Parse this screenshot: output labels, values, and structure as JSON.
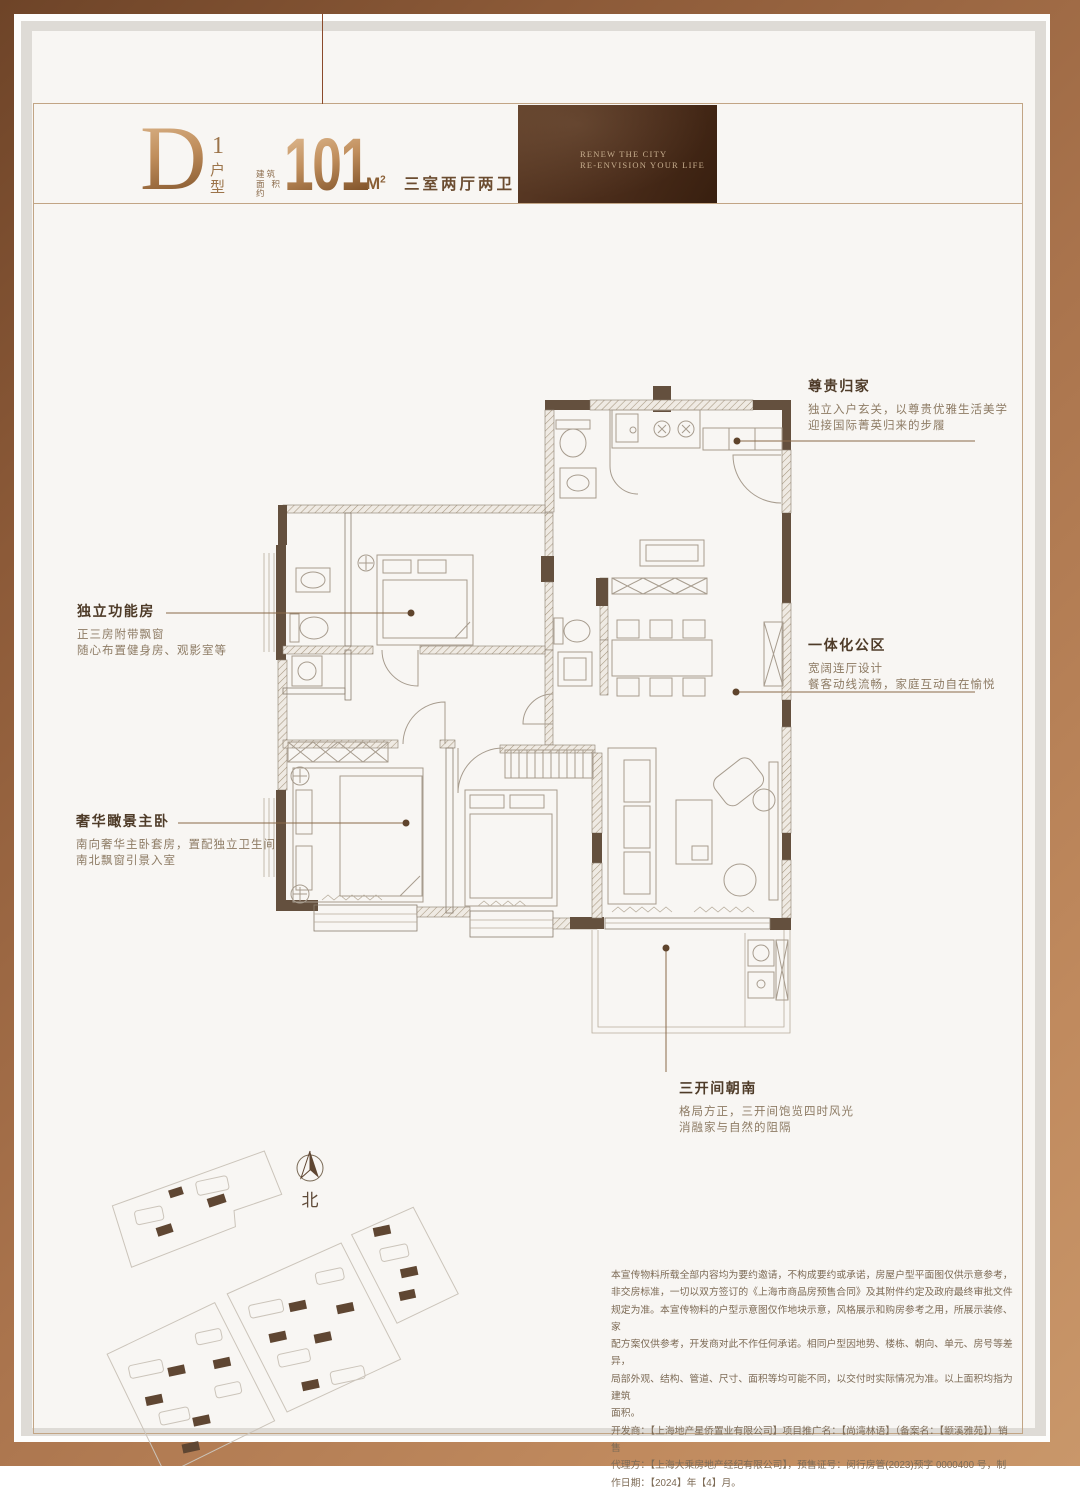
{
  "title_block": {
    "unit_letter": "D",
    "unit_number": "1",
    "unit_label": "户型",
    "area_prefix_1": "建筑",
    "area_prefix_2": "面积约",
    "area_value": "101",
    "area_unit_base": "M",
    "area_unit_exp": "2",
    "layout_summary": "三室两厅两卫",
    "brand_line1": "RENEW THE CITY",
    "brand_line2": "RE-ENVISION YOUR LIFE"
  },
  "callouts": {
    "homecoming": {
      "title": "尊贵归家",
      "body1": "独立入户玄关，以尊贵优雅生活美学",
      "body2": "迎接国际菁英归来的步履"
    },
    "function_room": {
      "title": "独立功能房",
      "body1": "正三房附带飘窗",
      "body2": "随心布置健身房、观影室等"
    },
    "public_area": {
      "title": "一体化公区",
      "body1": "宽阔连厅设计",
      "body2": "餐客动线流畅，家庭互动自在愉悦"
    },
    "master_bedroom": {
      "title": "奢华瞰景主卧",
      "body1": "南向奢华主卧套房，置配独立卫生间",
      "body2": "南北飘窗引景入室"
    },
    "south_bays": {
      "title": "三开间朝南",
      "body1": "格局方正，三开间饱览四时风光",
      "body2": "消融家与自然的阻隔"
    }
  },
  "compass": {
    "label": "北"
  },
  "disclaimer": {
    "lines": [
      "本宣传物料所载全部内容均为要约邀请，不构成要约或承诺，房屋户型平面图仅供示意参考，",
      "非交房标准，一切以双方签订的《上海市商品房预售合同》及其附件约定及政府最终审批文件",
      "规定为准。本宣传物料的户型示意图仅作地块示意，风格展示和购房参考之用，所展示装修、家",
      "配方案仅供参考，开发商对此不作任何承诺。相同户型因地势、楼栋、朝向、单元、房号等差异，",
      "局部外观、结构、管道、尺寸、面积等均可能不同，以交付时实际情况为准。以上面积均指为建筑",
      "面积。",
      "开发商：【上海地产星侨置业有限公司】项目推广名：【尚湾林语】（备案名：【颛溪雅苑】）销售",
      "代理方：【上海大乘房地产经纪有限公司】，预售证号：闵行房管(2023)预字 0000400 号，制",
      "作日期：【2024】年【4】月。"
    ]
  },
  "colors": {
    "frame_copper": "#a9734c",
    "wall_solid": "#64503e",
    "hatch_line": "#a6977f",
    "furniture_line": "#a79c8e",
    "leader_line": "#8a6a4a",
    "callout_title": "#4e3b28",
    "callout_body": "#8d7b64",
    "brand_box_bg": "#4a2c1a",
    "brand_box_text": "#c7ae8e"
  }
}
